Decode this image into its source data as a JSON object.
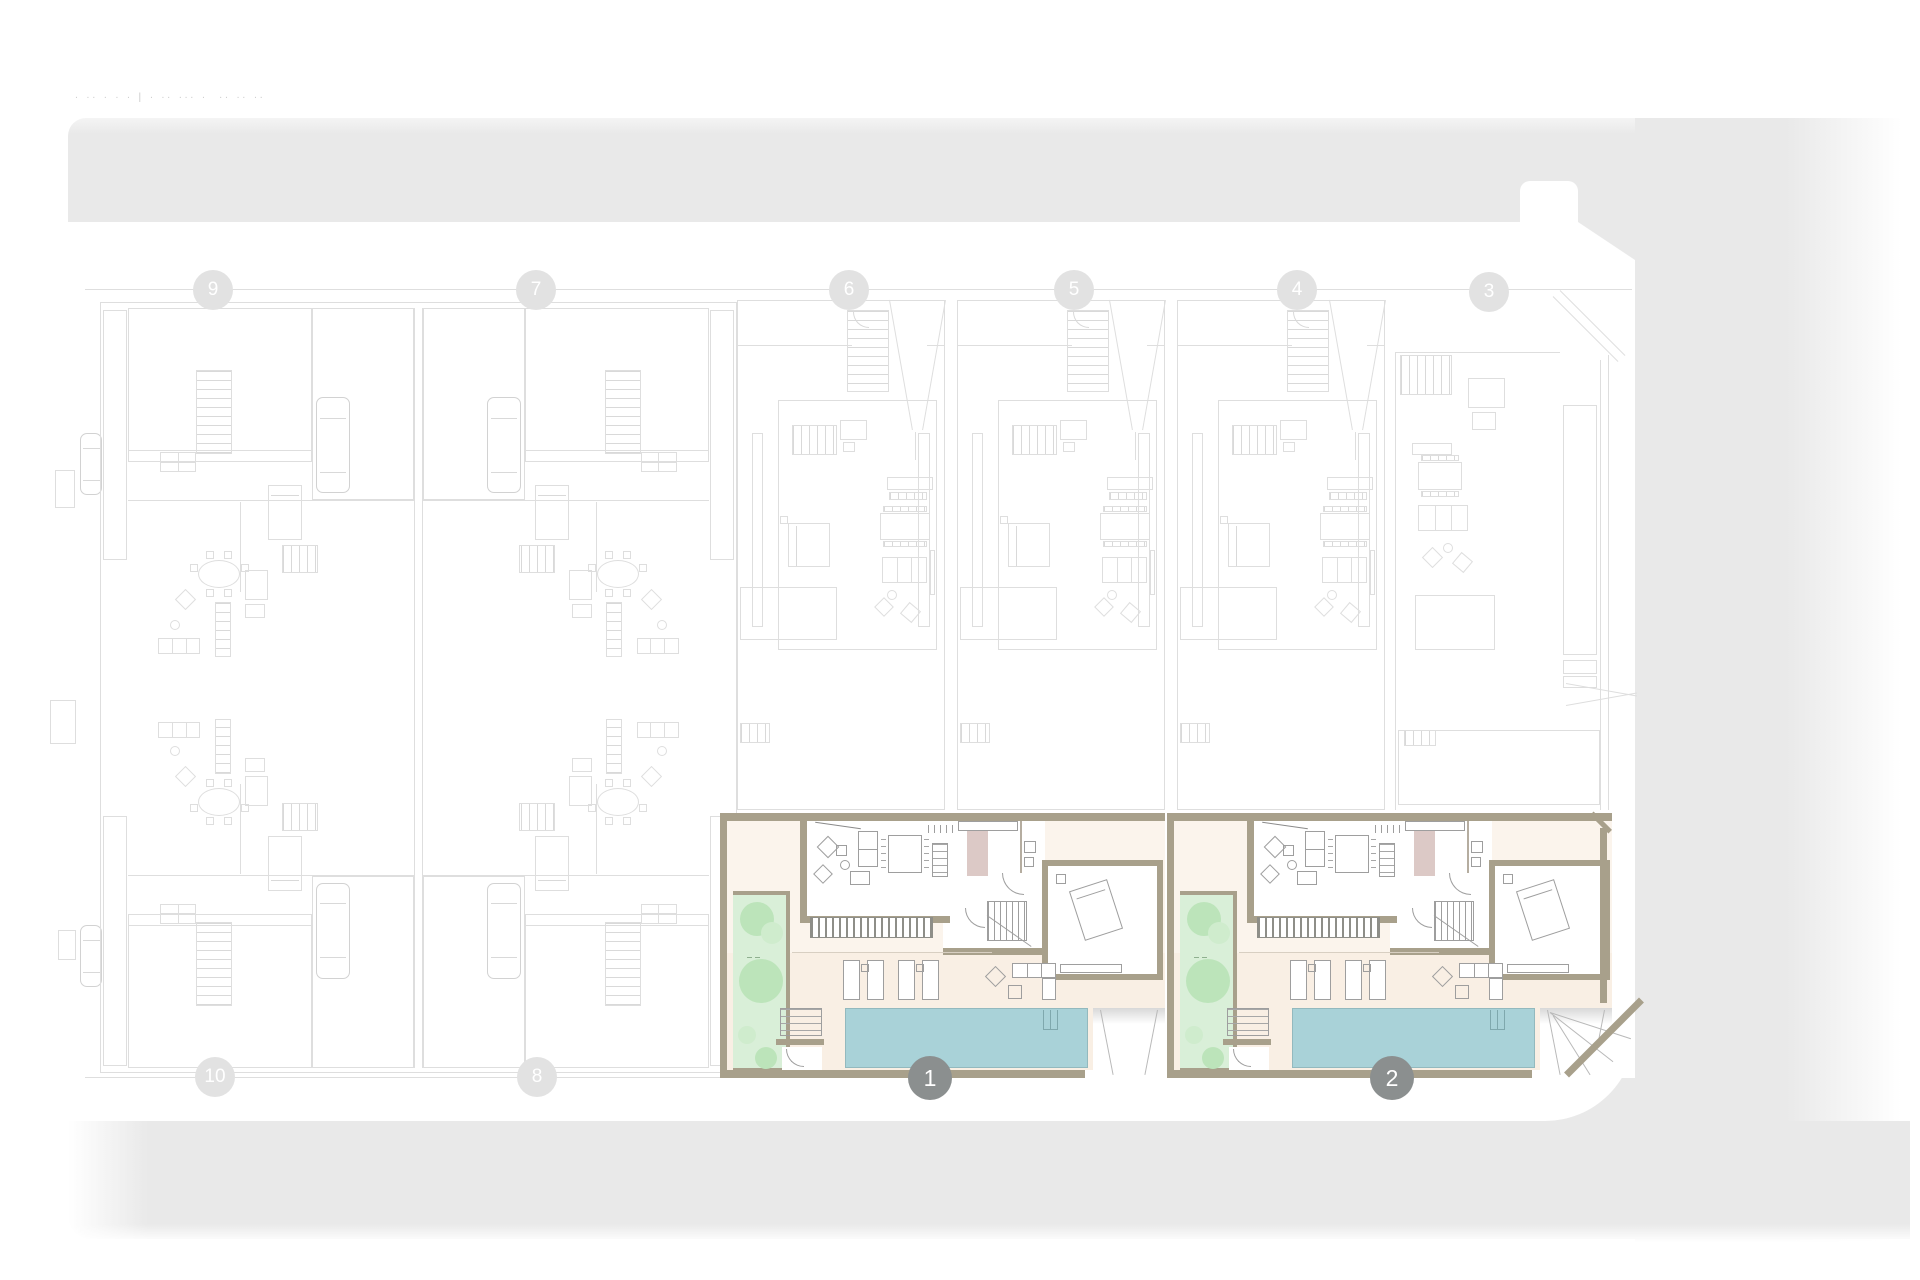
{
  "app": {
    "type": "architectural-site-plan",
    "floor_caption": "∙ ∙∙ ∙ ∙ ∙ | ∙ ∙∙ ∙∙∙ ∙  ∙∙ ∙∙ ∙∙"
  },
  "palette": {
    "street_gray": "#e9e9e9",
    "faded_line": "#dedede",
    "wall_olive": "#a8a08b",
    "floor_cream": "#f9efe4",
    "pool_teal": "#a9d2d8",
    "garden_green": "#d9efd8",
    "tree_green": "#bce4ba",
    "wardrobe_mauve": "#dcc9c6",
    "marker_gray": "#8b8f8f",
    "marker_faded": "#e2e2e2"
  },
  "markers": {
    "highlighted": [
      {
        "label": "1"
      },
      {
        "label": "2"
      }
    ],
    "faded": [
      {
        "label": "9"
      },
      {
        "label": "7"
      },
      {
        "label": "6"
      },
      {
        "label": "5"
      },
      {
        "label": "4"
      },
      {
        "label": "3"
      },
      {
        "label": "10"
      },
      {
        "label": "8"
      }
    ]
  }
}
